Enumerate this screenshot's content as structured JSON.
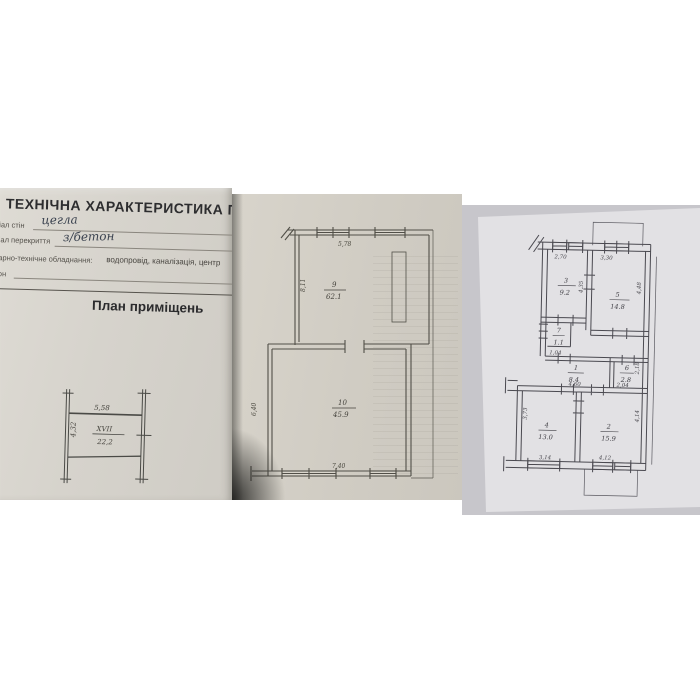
{
  "photo_left": {
    "title": "ТЕХНІЧНА ХАРАКТЕРИСТИКА П",
    "row_walls_label": "іал стін",
    "row_walls_value": "цегла",
    "row_ceiling_label": "іал перекриття",
    "row_ceiling_value": "з/бетон",
    "row_equipment_label": "арно-технічне обладнання:",
    "row_equipment_value": "водопровід,  каналізація,  центр",
    "row_extra_label": "он",
    "plan_heading": "План приміщень",
    "sketch": {
      "top_dim": "5,58",
      "left_dim": "4,32",
      "room_no": "XVII",
      "area": "22,2"
    }
  },
  "photo_middle": {
    "room9": {
      "no": "9",
      "area": "62.1",
      "top_dim": "5,78",
      "left_dim": "8,11"
    },
    "room10": {
      "no": "10",
      "area": "45.9",
      "left_dim": "6,40",
      "bottom_dim": "7,40"
    }
  },
  "photo_right": {
    "room3": {
      "no": "3",
      "area": "9.2",
      "top_dim": "2,70",
      "side_dim": "4,35"
    },
    "room5": {
      "no": "5",
      "area": "14.8",
      "top_dim": "3,30",
      "side_dim": "4,48"
    },
    "closet": {
      "no": "7",
      "area": "1.1",
      "bottom_dim": "1,04"
    },
    "corridor": {
      "no": "1",
      "area": "8.4",
      "bottom_dim": "4,60"
    },
    "room6": {
      "no": "6",
      "area": "2.8",
      "bottom_dim": "2,04",
      "side_dim": "2,18"
    },
    "room4": {
      "no": "4",
      "area": "13.0",
      "bottom_dim": "3,14",
      "side_dim": "3,73"
    },
    "room2": {
      "no": "2",
      "area": "15.9",
      "bottom_dim": "4,12",
      "side_dim": "4,14"
    }
  }
}
